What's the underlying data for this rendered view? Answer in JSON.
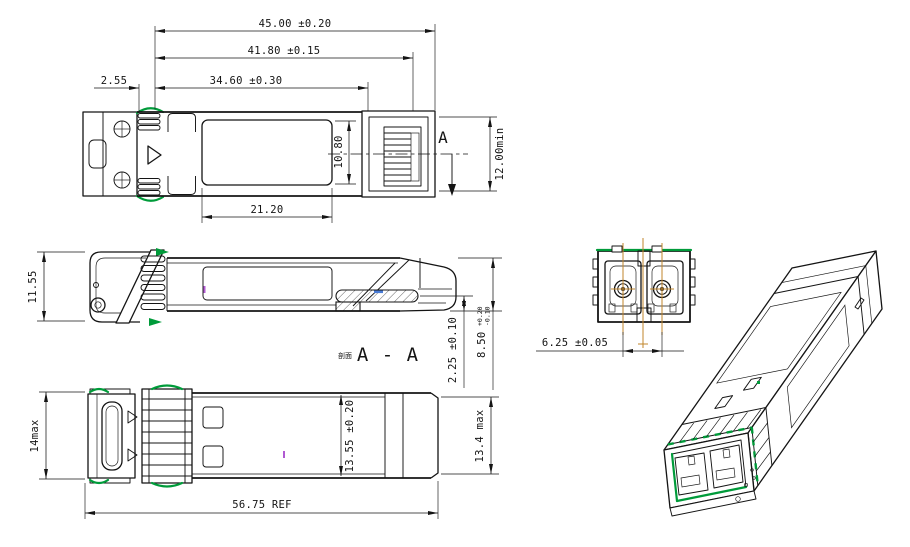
{
  "colors": {
    "line": "#141414",
    "green": "#009b3a",
    "orange": "#c1862b",
    "blue": "#4a7bd5",
    "purple": "#b05ad2",
    "bg": "#ffffff"
  },
  "views": {
    "top": {
      "dims": {
        "overall_length": "45.00 ±0.20",
        "housing_length": "41.80 ±0.15",
        "cage_length": "34.60 ±0.30",
        "front_offset": "2.55",
        "label_length": "21.20",
        "label_width": "10.80",
        "insertion_depth_min": "12.00min"
      },
      "section_letter": "A"
    },
    "side": {
      "dims": {
        "latch_height": "11.55",
        "pcb_center_offset": "2.25 ±0.10",
        "body_height": "8.50",
        "body_height_tol_upper": "+0.20",
        "body_height_tol_lower": "-0.10"
      },
      "section_prefix": "剖面",
      "section_label": "A - A"
    },
    "bottom": {
      "dims": {
        "latch_height_max": "14max",
        "body_width": "13.55 ±0.20",
        "overall_width_max": "13.4 max",
        "overall_length_ref": "56.75 REF"
      }
    },
    "front": {
      "dims": {
        "lc_port_pitch": "6.25 ±0.05"
      }
    }
  }
}
